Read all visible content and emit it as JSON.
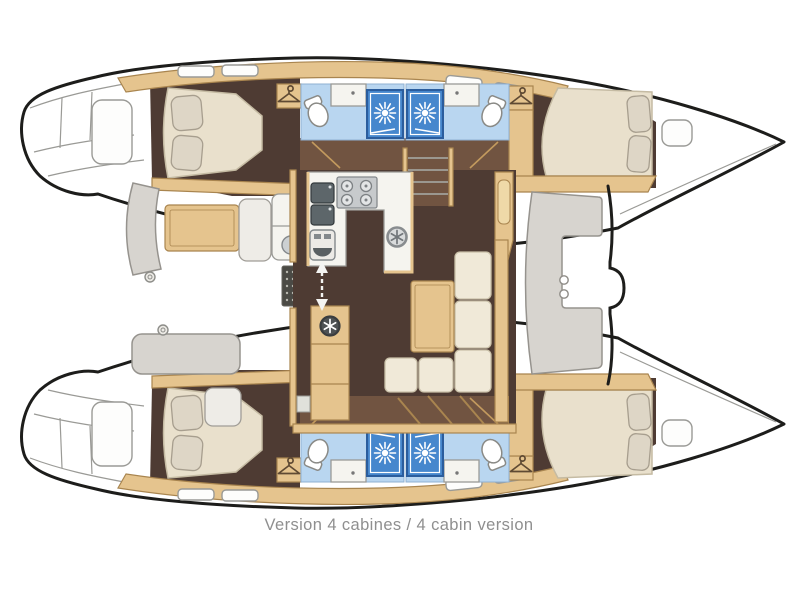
{
  "caption": "Version 4 cabines / 4 cabin version",
  "plan": {
    "type": "catamaran-interior-floor-plan",
    "cabin_count": 4,
    "shower_room_count": 4,
    "berth_count": 4
  },
  "icons": [
    "shower-head-icon",
    "clothes-hanger-icon",
    "toilet-icon",
    "washbasin-icon",
    "stove-burners-icon",
    "double-sink-icon",
    "galley-appliance-icon",
    "vent-fan-icon",
    "companionway-arrow-icon",
    "winch-icon",
    "deck-hatch-icon"
  ],
  "colors": {
    "outline": "#1d1d1b",
    "line": "#9a9a96",
    "floor": "#4e3b33",
    "floormid": "#715441",
    "wood": "#e5c48e",
    "woodedge": "#a9854f",
    "bed": "#e9e0cc",
    "bededge": "#c5bba3",
    "pillow": "#ded6c6",
    "pillowedge": "#a79e8e",
    "bath": "#b9d6f0",
    "shower": "#4687cd",
    "showeredge": "#2b5d9d",
    "counter": "#f5f4ef",
    "appliance": "#c7cacc",
    "applianceedge": "#84898c",
    "seat": "#d7d4cf",
    "seatedge": "#96938e",
    "cushion": "#f0e9d8",
    "cushionedge": "#c9c0a8",
    "sinkdark": "#5d666a",
    "mat": "#4b4a45",
    "caption": "#8f8f8f"
  }
}
